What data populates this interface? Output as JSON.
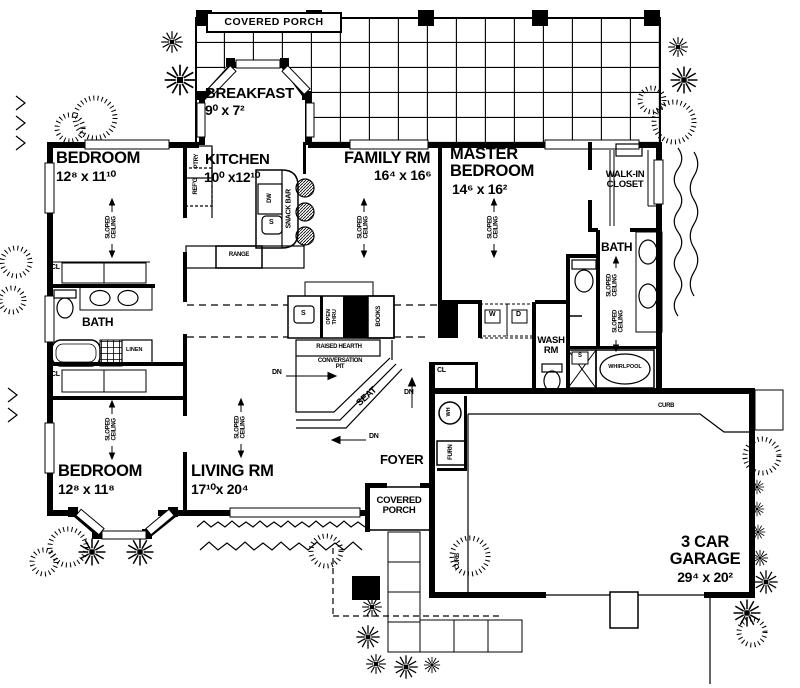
{
  "rooms": {
    "covered_porch_top": "COVERED  PORCH",
    "breakfast": {
      "name": "BREAKFAST",
      "dims": "9⁰ x  7²"
    },
    "bedroom_upper": {
      "name": "BEDROOM",
      "dims": "12⁸ x  11¹⁰"
    },
    "kitchen": {
      "name": "KITCHEN",
      "dims": "10⁰ x12¹⁰"
    },
    "family_rm": {
      "name": "FAMILY  RM",
      "dims": "16⁴ x  16⁶"
    },
    "master_bedroom": {
      "name": "MASTER\nBEDROOM",
      "dims": "14⁶ x  16²"
    },
    "walk_in_closet": "WALK-IN\nCLOSET",
    "master_bath": "BATH",
    "hall_bath": "BATH",
    "bedroom_lower": {
      "name": "BEDROOM",
      "dims": "12⁸ x  11⁸"
    },
    "living_rm": {
      "name": "LIVING  RM",
      "dims": "17¹⁰x  20⁴"
    },
    "wash_rm": "WASH\nRM",
    "foyer": "FOYER",
    "covered_porch_front": "COVERED\nPORCH",
    "garage": {
      "name": "3  CAR\nGARAGE",
      "dims": "29⁴ x  20²"
    }
  },
  "annotations": {
    "sloped_ceiling": "SLOPED\nCEILING",
    "closet": "CL",
    "down": "DN",
    "curb": "CURB",
    "linen": "LINEN",
    "pantry": "PTRY",
    "refrigerator": "REF'G",
    "dishwasher": "DW",
    "sink": "S",
    "snack_bar": "SNACK  BAR",
    "range": "RANGE",
    "open_thru": "OPEN\nTHRU",
    "books": "BOOKS",
    "raised_hearth": "RAISED  HEARTH",
    "conversation_pit": "CONVERSATION\nPIT",
    "seat": "SEAT",
    "washer": "W",
    "dryer": "D",
    "whirlpool": "WHIRLPOOL",
    "water_heater": "WH",
    "furnace": "FURN"
  },
  "colors": {
    "ink": "#000000",
    "paper": "#ffffff"
  }
}
